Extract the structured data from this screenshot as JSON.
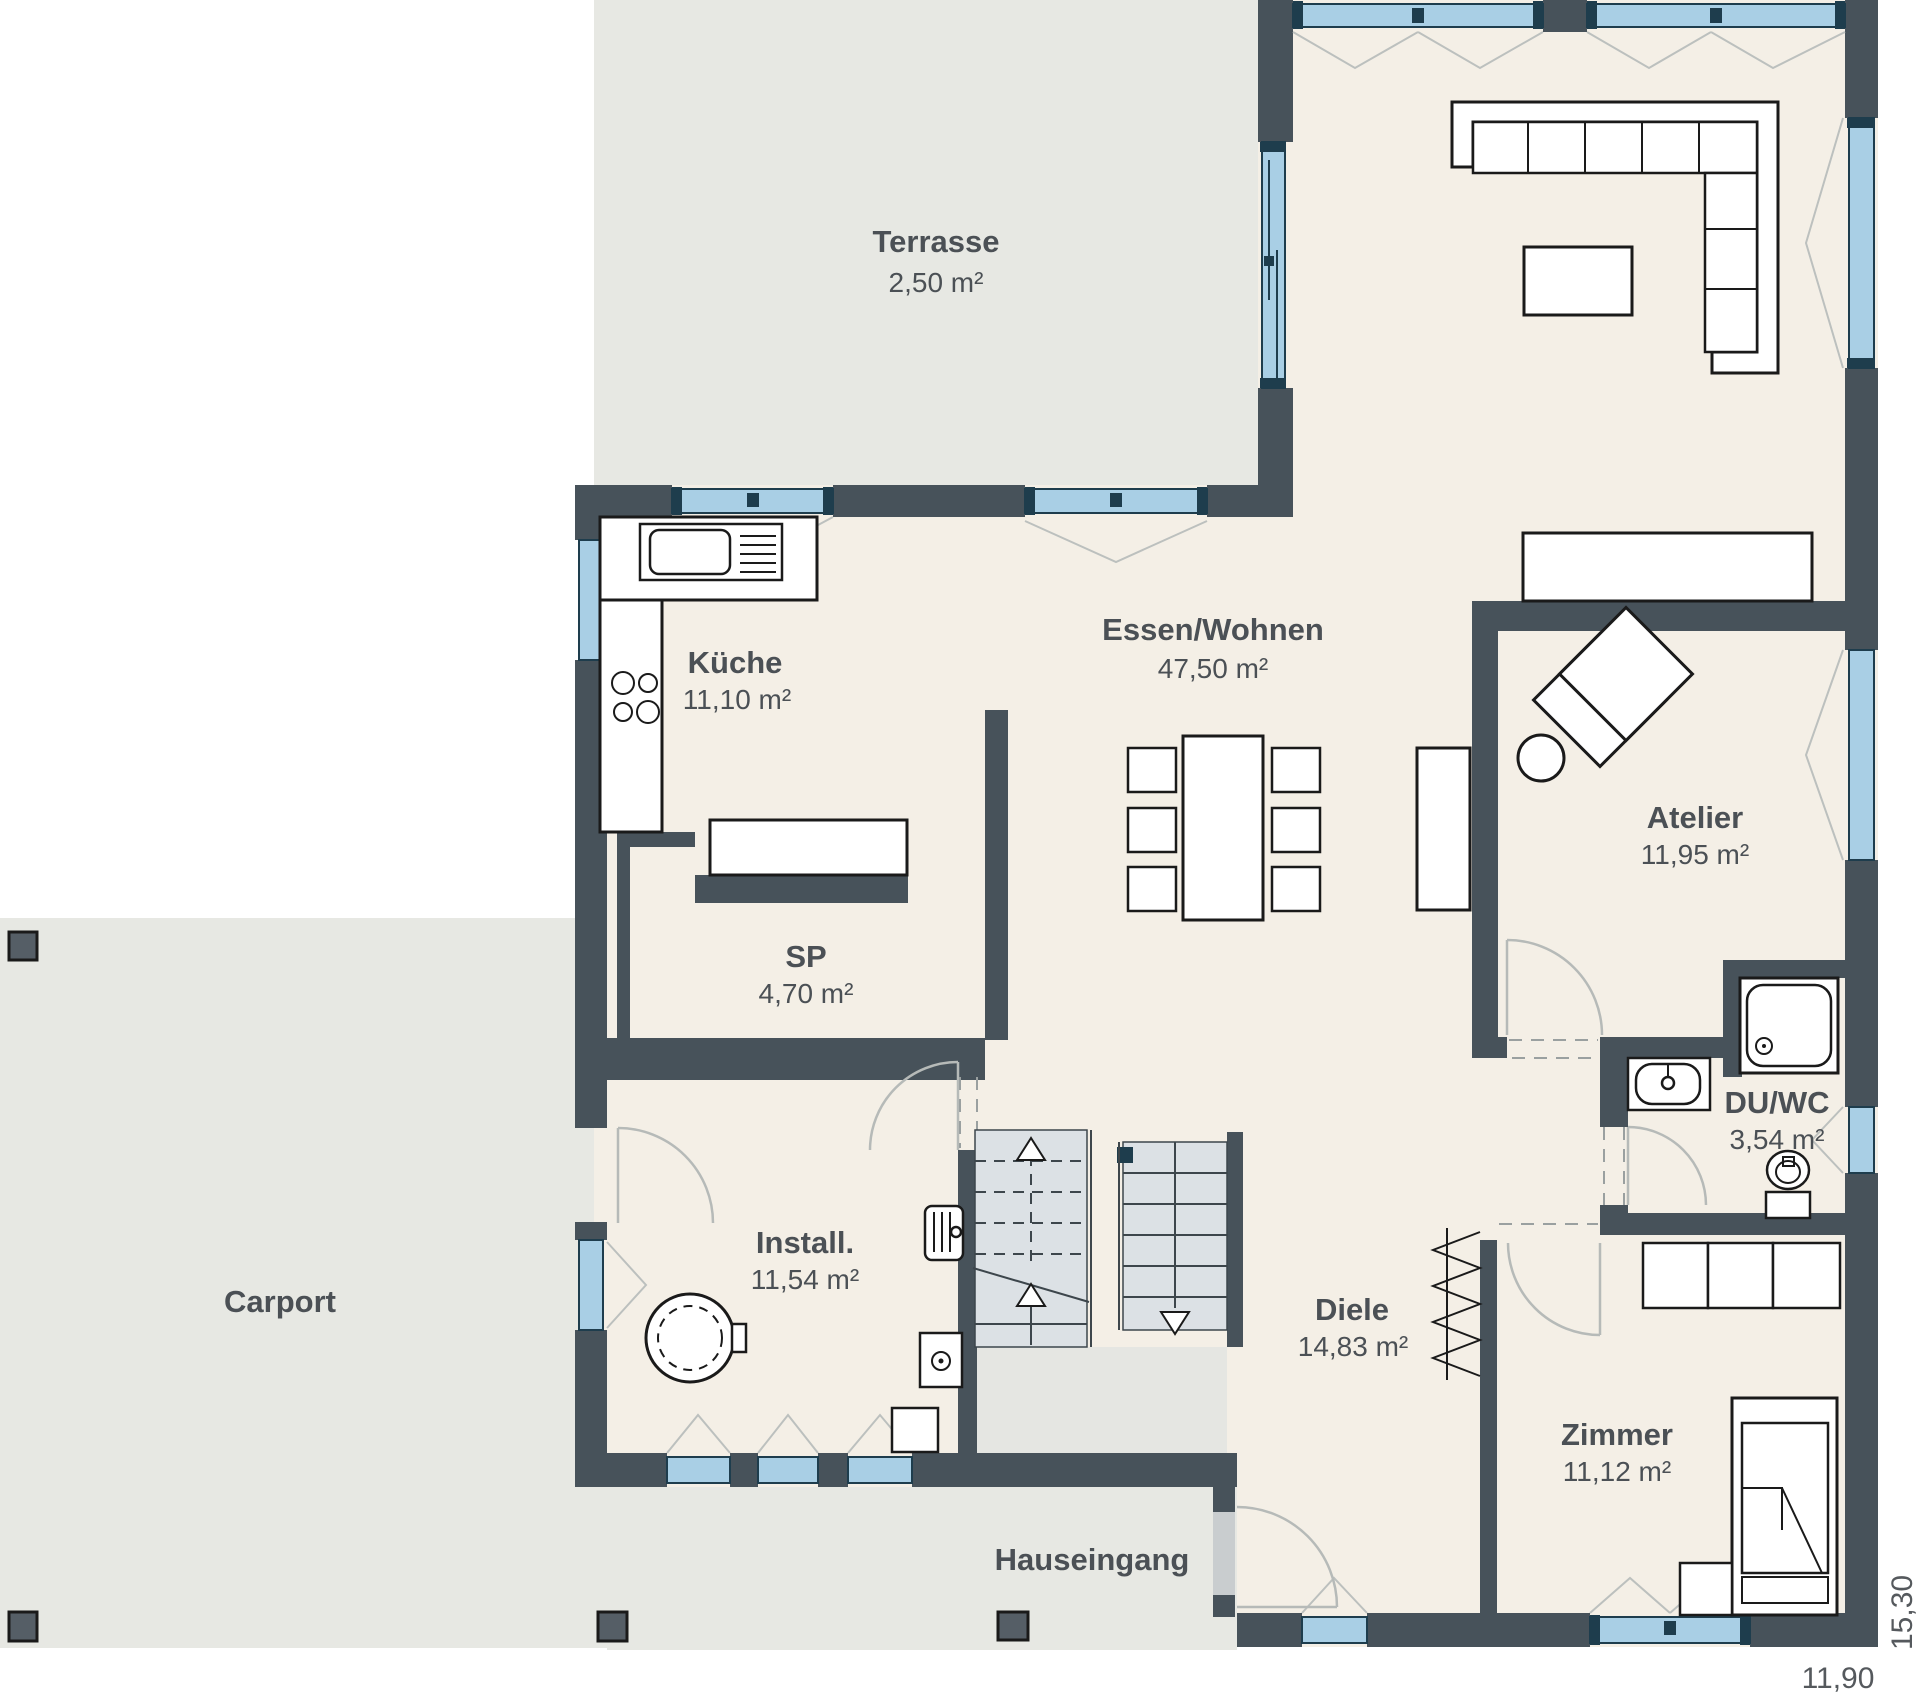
{
  "plan": {
    "title": "Erdgeschoss Grundriss",
    "rooms": [
      {
        "id": "terrasse",
        "name": "Terrasse",
        "area": "2,50 m²"
      },
      {
        "id": "kueche",
        "name": "Küche",
        "area": "11,10 m²"
      },
      {
        "id": "essen_wohnen",
        "name": "Essen/Wohnen",
        "area": "47,50 m²"
      },
      {
        "id": "atelier",
        "name": "Atelier",
        "area": "11,95 m²"
      },
      {
        "id": "sp",
        "name": "SP",
        "area": "4,70 m²"
      },
      {
        "id": "install",
        "name": "Install.",
        "area": "11,54 m²"
      },
      {
        "id": "diele",
        "name": "Diele",
        "area": "14,83 m²"
      },
      {
        "id": "du_wc",
        "name": "DU/WC",
        "area": "3,54 m²"
      },
      {
        "id": "zimmer",
        "name": "Zimmer",
        "area": "11,12 m²"
      },
      {
        "id": "carport",
        "name": "Carport",
        "area": ""
      },
      {
        "id": "hauseingang",
        "name": "Hauseingang",
        "area": ""
      }
    ],
    "dimensions": {
      "width": "11,90",
      "height": "15,30"
    },
    "colors": {
      "wall": "#47525A",
      "floor": "#F4EFE6",
      "outdoor": "#E7E8E3",
      "window": "#A9CFE5",
      "window_frame": "#1E3D4D",
      "stairs": "#DCE1E5",
      "door_swing": "#B6BAB8",
      "furniture_outline": "#1A1A1A",
      "text": "#4B5055"
    }
  }
}
